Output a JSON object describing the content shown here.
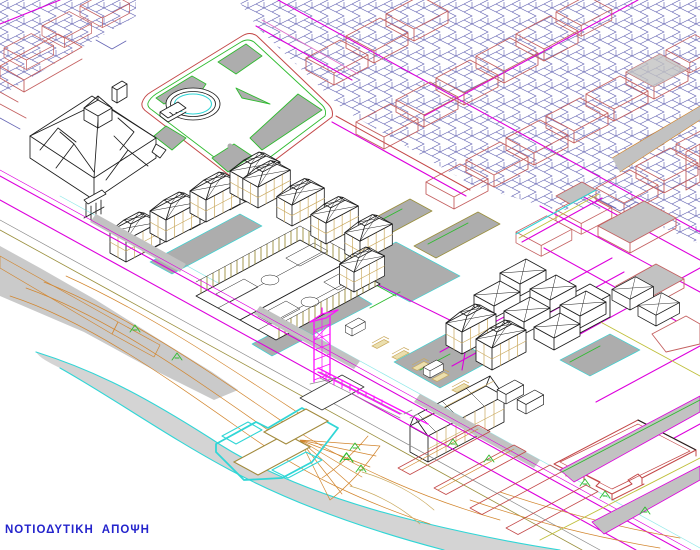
{
  "caption": {
    "text": "ΝΟΤΙΟΔΥΤΙΚΗ  ΑΠΟΨΗ"
  },
  "palette": {
    "paper": "#FFFFFF",
    "ink": "#1C1C1C",
    "city-red": "#C46060",
    "deep-red": "#C34848",
    "parcel-blue": "#6666B4",
    "road-magenta": "#DD00DD",
    "struct-magenta": "#FF10FF",
    "pink": "#E070C8",
    "shore-cyan": "#30D6D6",
    "green": "#2FBB2F",
    "contour-orange": "#D2862F",
    "facade-tan": "#C9A85C",
    "olive": "#9A8F3C",
    "paving-gray": "#ADADAD",
    "terrain-gray": "#CACACA",
    "shore-gray": "#D4D4D4",
    "lavender": "#9C9CD2",
    "label-blue": "#2424CC",
    "yellow-green": "#BFBF3A"
  },
  "legend": {
    "city-red": "existing city blocks",
    "parcel-blue": "cadastral parcel lines",
    "road-magenta": "streets and boundaries",
    "struct-magenta": "tower and footbridge",
    "shore-cyan": "shoreline and planting edges",
    "green": "vegetation",
    "contour-orange": "terrain contours and stairs",
    "facade-tan": "glazing mullions",
    "paving-gray": "paved surfaces",
    "ink": "proposed buildings"
  }
}
